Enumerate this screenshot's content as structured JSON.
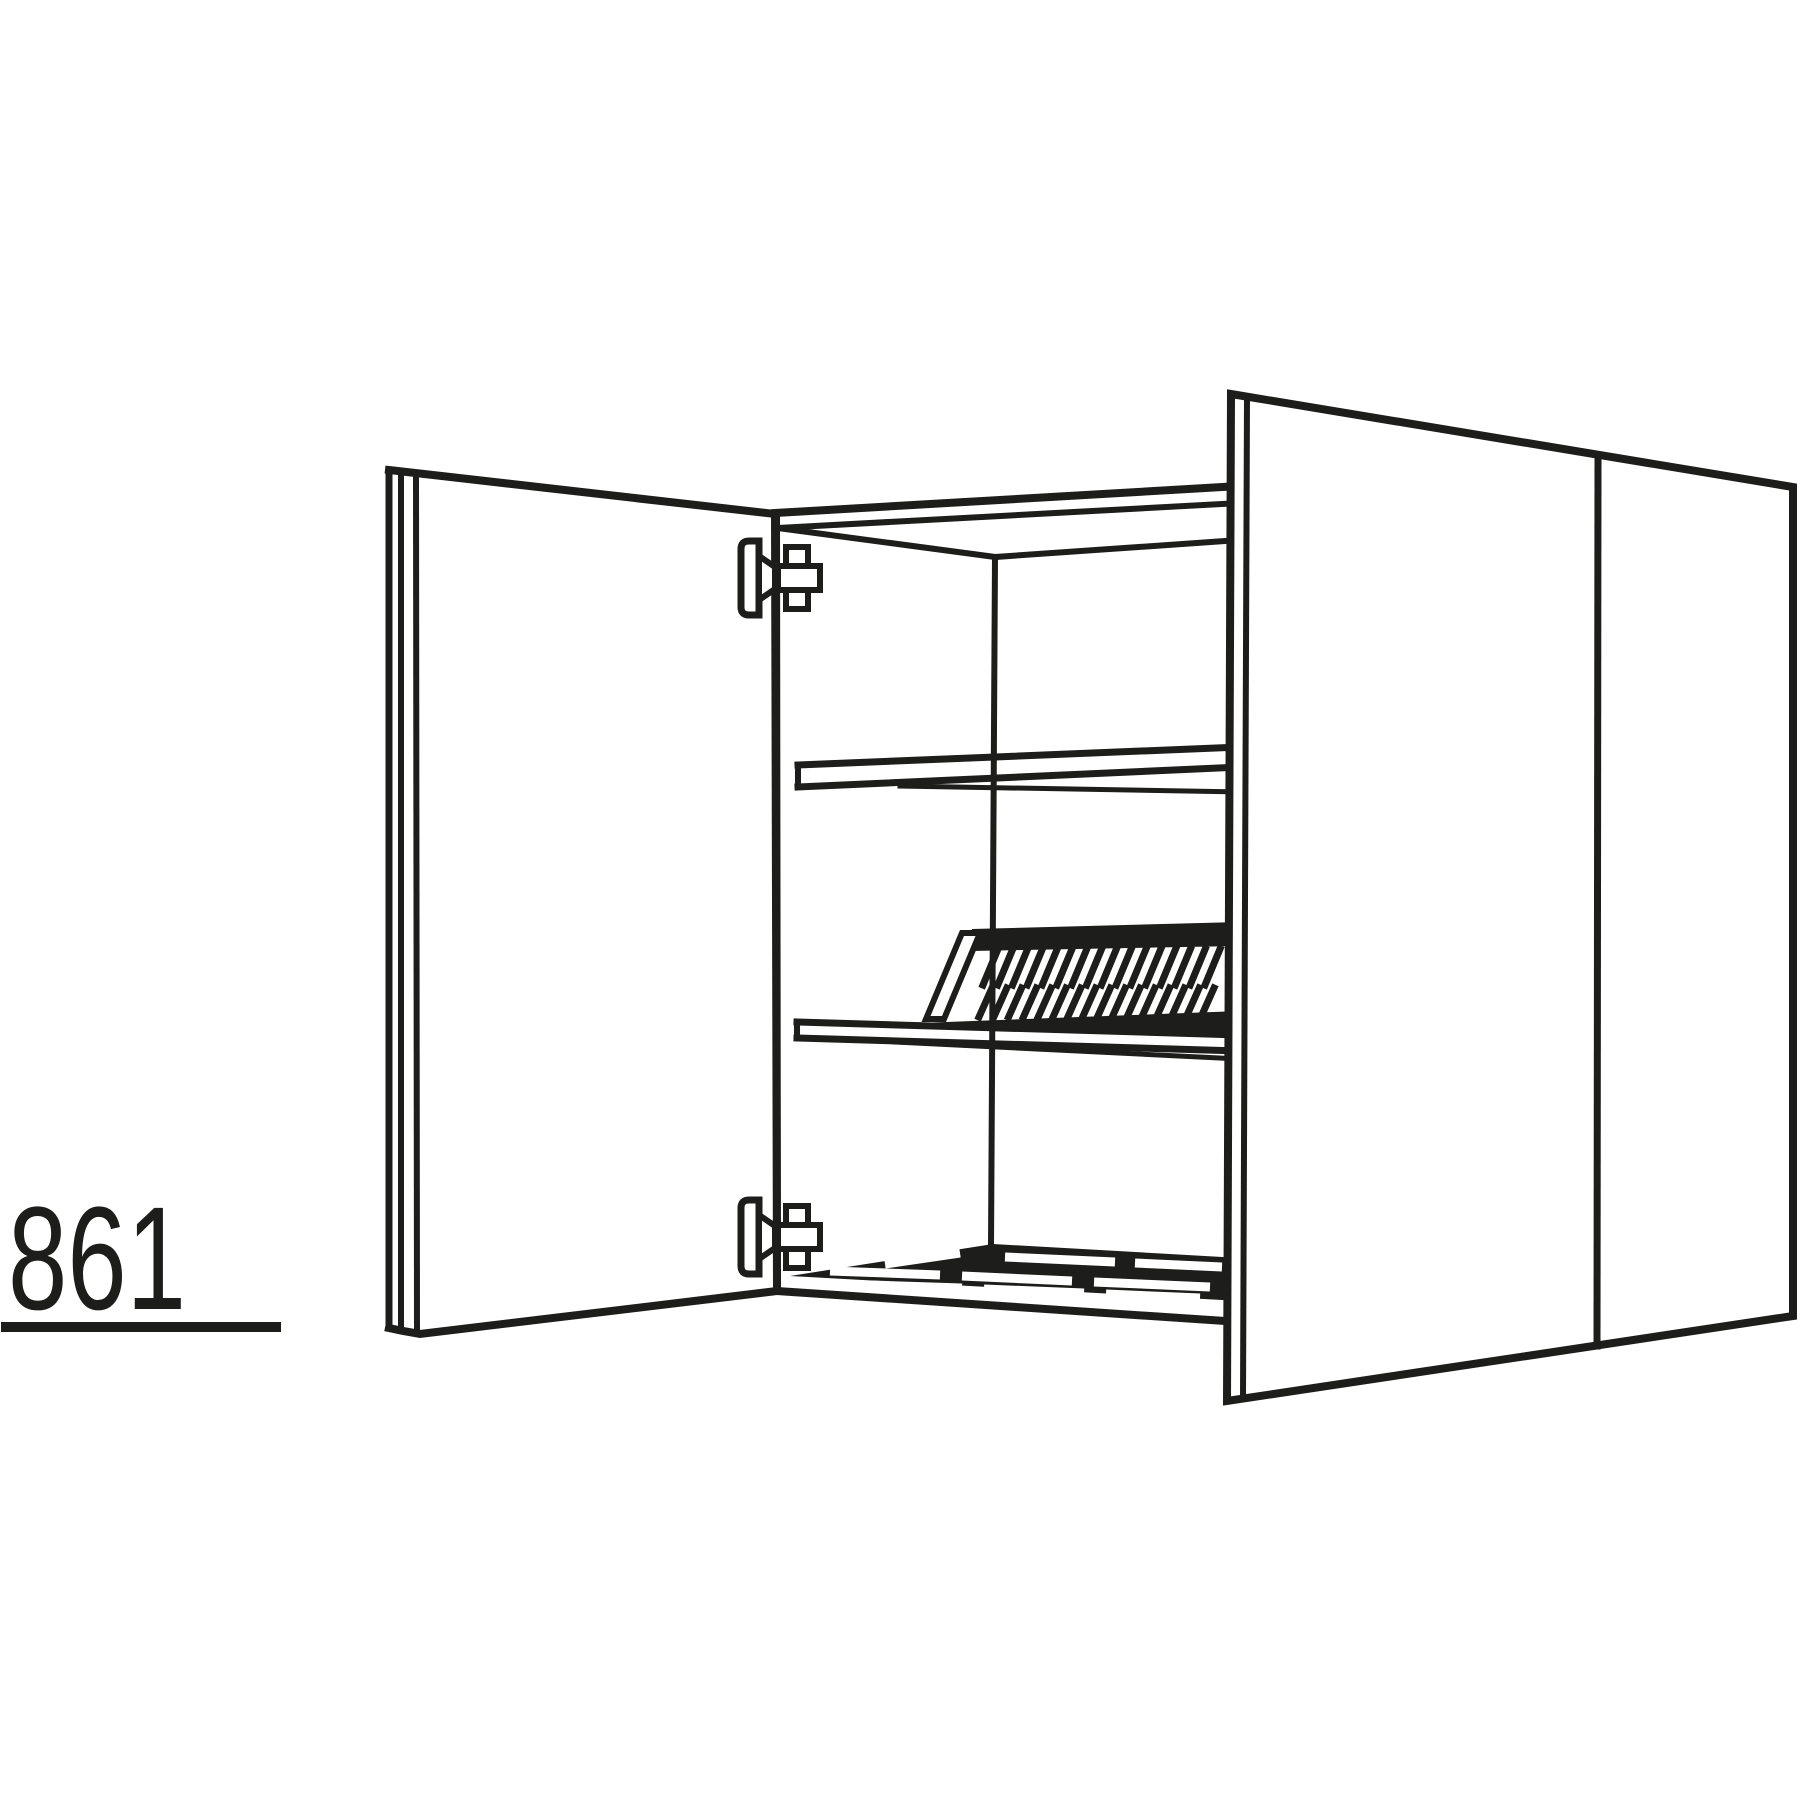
{
  "diagram": {
    "dimension_label": "861",
    "colors": {
      "line": "#1d1d1b",
      "background": "#ffffff"
    },
    "parts": {
      "open_door": "open-left-door",
      "right_doors": "closed-double-doors",
      "door_divider": "door-gap-line",
      "carcass": "cabinet-carcass",
      "shelf_upper": "plain-shelf",
      "shelf_middle": "shelf-with-plate-rack",
      "plate_rack": "plate-drying-rack",
      "wire_rack": "wire-drying-rack",
      "hinge_top": "hinge-top",
      "hinge_bottom": "hinge-bottom"
    }
  }
}
